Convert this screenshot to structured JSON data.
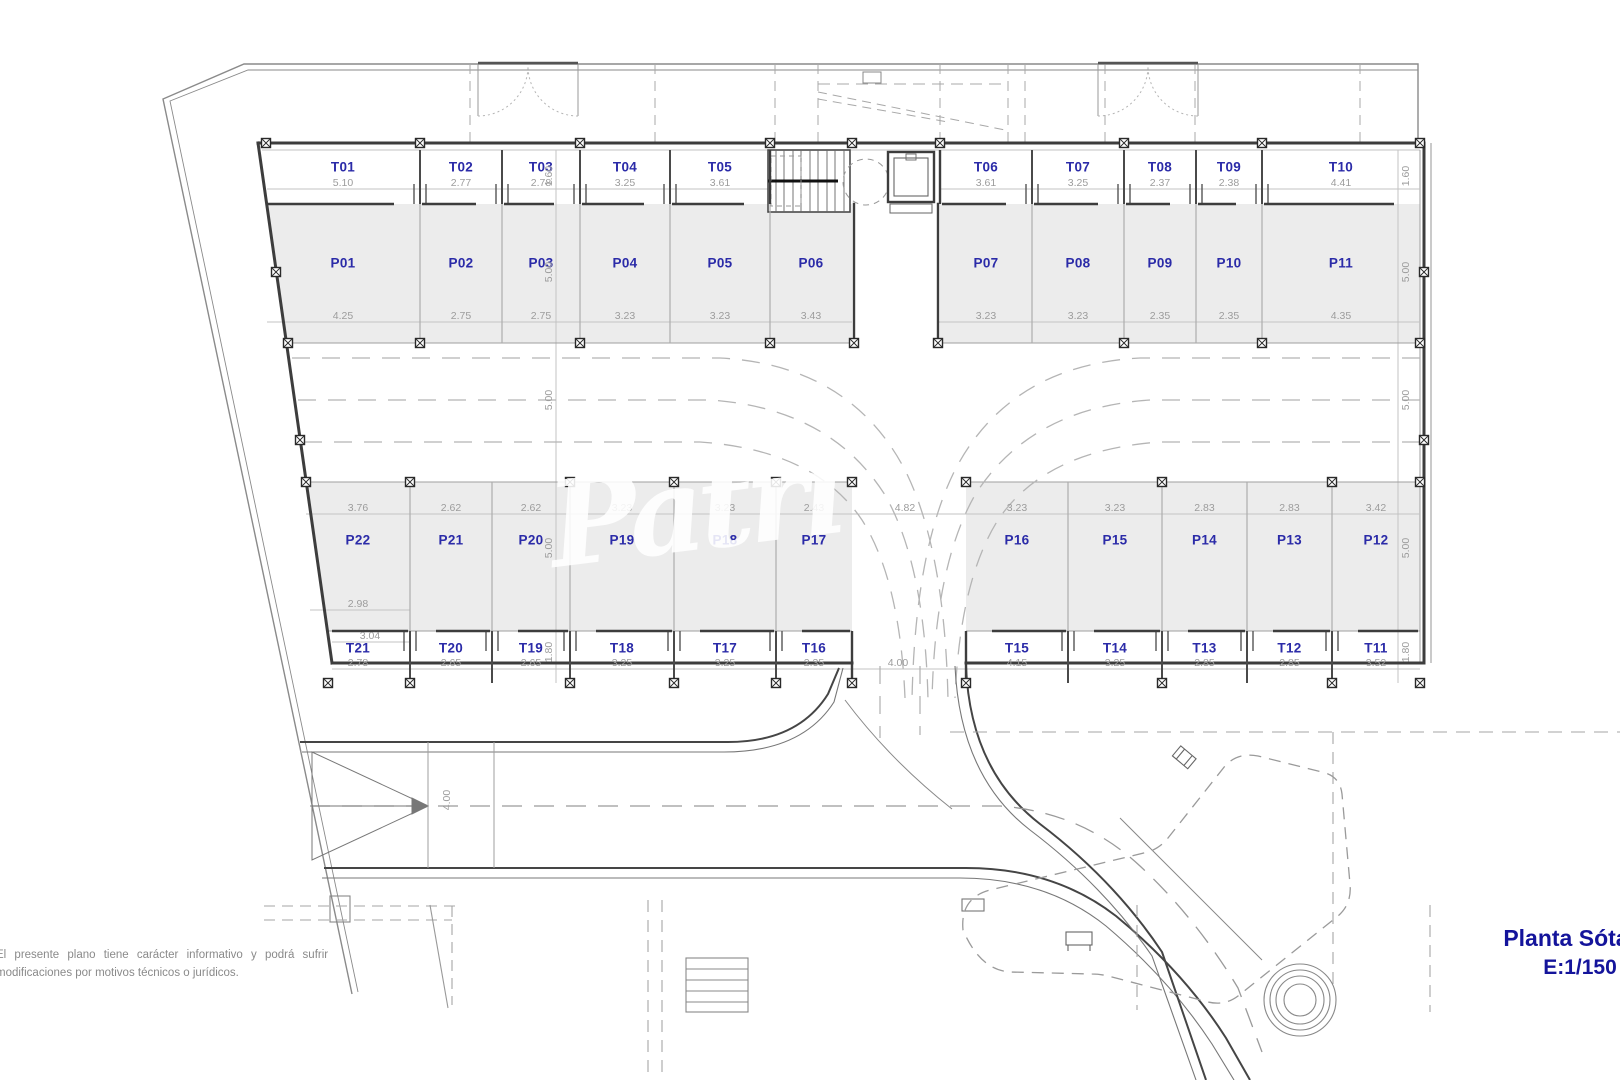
{
  "plan": {
    "title": "Planta Sótano",
    "scale": "E:1/150",
    "watermark": "Patri",
    "disclaimer": [
      "El presente plano tiene carácter informativo y podrá sufrir",
      "modificaciones por motivos técnicos o jurídicos."
    ]
  },
  "colors": {
    "label_blue": "#2b2ba8",
    "title_blue": "#14149b",
    "dim_gray": "#9c9c9c",
    "fill_gray": "#ececec",
    "wall_dark": "#3d3d3d"
  },
  "units": {
    "top_storage": [
      {
        "id": "T01",
        "dim": "5.10"
      },
      {
        "id": "T02",
        "dim": "2.77"
      },
      {
        "id": "T03",
        "dim": "2.78"
      },
      {
        "id": "T04",
        "dim": "3.25"
      },
      {
        "id": "T05",
        "dim": "3.61"
      },
      {
        "id": "T06",
        "dim": "3.61"
      },
      {
        "id": "T07",
        "dim": "3.25"
      },
      {
        "id": "T08",
        "dim": "2.37"
      },
      {
        "id": "T09",
        "dim": "2.38"
      },
      {
        "id": "T10",
        "dim": "4.41"
      }
    ],
    "top_parking": [
      {
        "id": "P01",
        "dim": "4.25"
      },
      {
        "id": "P02",
        "dim": "2.75"
      },
      {
        "id": "P03",
        "dim": "2.75"
      },
      {
        "id": "P04",
        "dim": "3.23"
      },
      {
        "id": "P05",
        "dim": "3.23"
      },
      {
        "id": "P06",
        "dim": "3.43"
      },
      {
        "id": "P07",
        "dim": "3.23"
      },
      {
        "id": "P08",
        "dim": "3.23"
      },
      {
        "id": "P09",
        "dim": "2.35"
      },
      {
        "id": "P10",
        "dim": "2.35"
      },
      {
        "id": "P11",
        "dim": "4.35"
      }
    ],
    "bottom_parking": [
      {
        "id": "P22",
        "dim": "3.76"
      },
      {
        "id": "P21",
        "dim": "2.62"
      },
      {
        "id": "P20",
        "dim": "2.62"
      },
      {
        "id": "P19",
        "dim": "3.23"
      },
      {
        "id": "P18",
        "dim": "3.23"
      },
      {
        "id": "P17",
        "dim": "2.43"
      },
      {
        "id": "P16",
        "dim": "3.23"
      },
      {
        "id": "P15",
        "dim": "3.23"
      },
      {
        "id": "P14",
        "dim": "2.83"
      },
      {
        "id": "P13",
        "dim": "2.83"
      },
      {
        "id": "P12",
        "dim": "3.42"
      }
    ],
    "bottom_storage": [
      {
        "id": "T21",
        "dim": "2.78"
      },
      {
        "id": "T20",
        "dim": "2.65"
      },
      {
        "id": "T19",
        "dim": "2.65"
      },
      {
        "id": "T18",
        "dim": "3.25"
      },
      {
        "id": "T17",
        "dim": "3.25"
      },
      {
        "id": "T16",
        "dim": "2.35"
      },
      {
        "id": "T15",
        "dim": "4.15"
      },
      {
        "id": "T14",
        "dim": "3.25"
      },
      {
        "id": "T13",
        "dim": "2.85"
      },
      {
        "id": "T12",
        "dim": "2.85"
      },
      {
        "id": "T11",
        "dim": "3.52"
      }
    ]
  },
  "dims": {
    "left_chain": [
      "1.60",
      "5.00",
      "5.00",
      "5.00",
      "1.80"
    ],
    "right_chain": [
      "1.60",
      "5.00",
      "5.00",
      "5.00",
      "1.80"
    ],
    "p22_depth": "2.98",
    "t21_width": "3.04",
    "road_width_top": "4.82",
    "road_width_bottom": "4.00",
    "ramp_width": "4.00"
  }
}
